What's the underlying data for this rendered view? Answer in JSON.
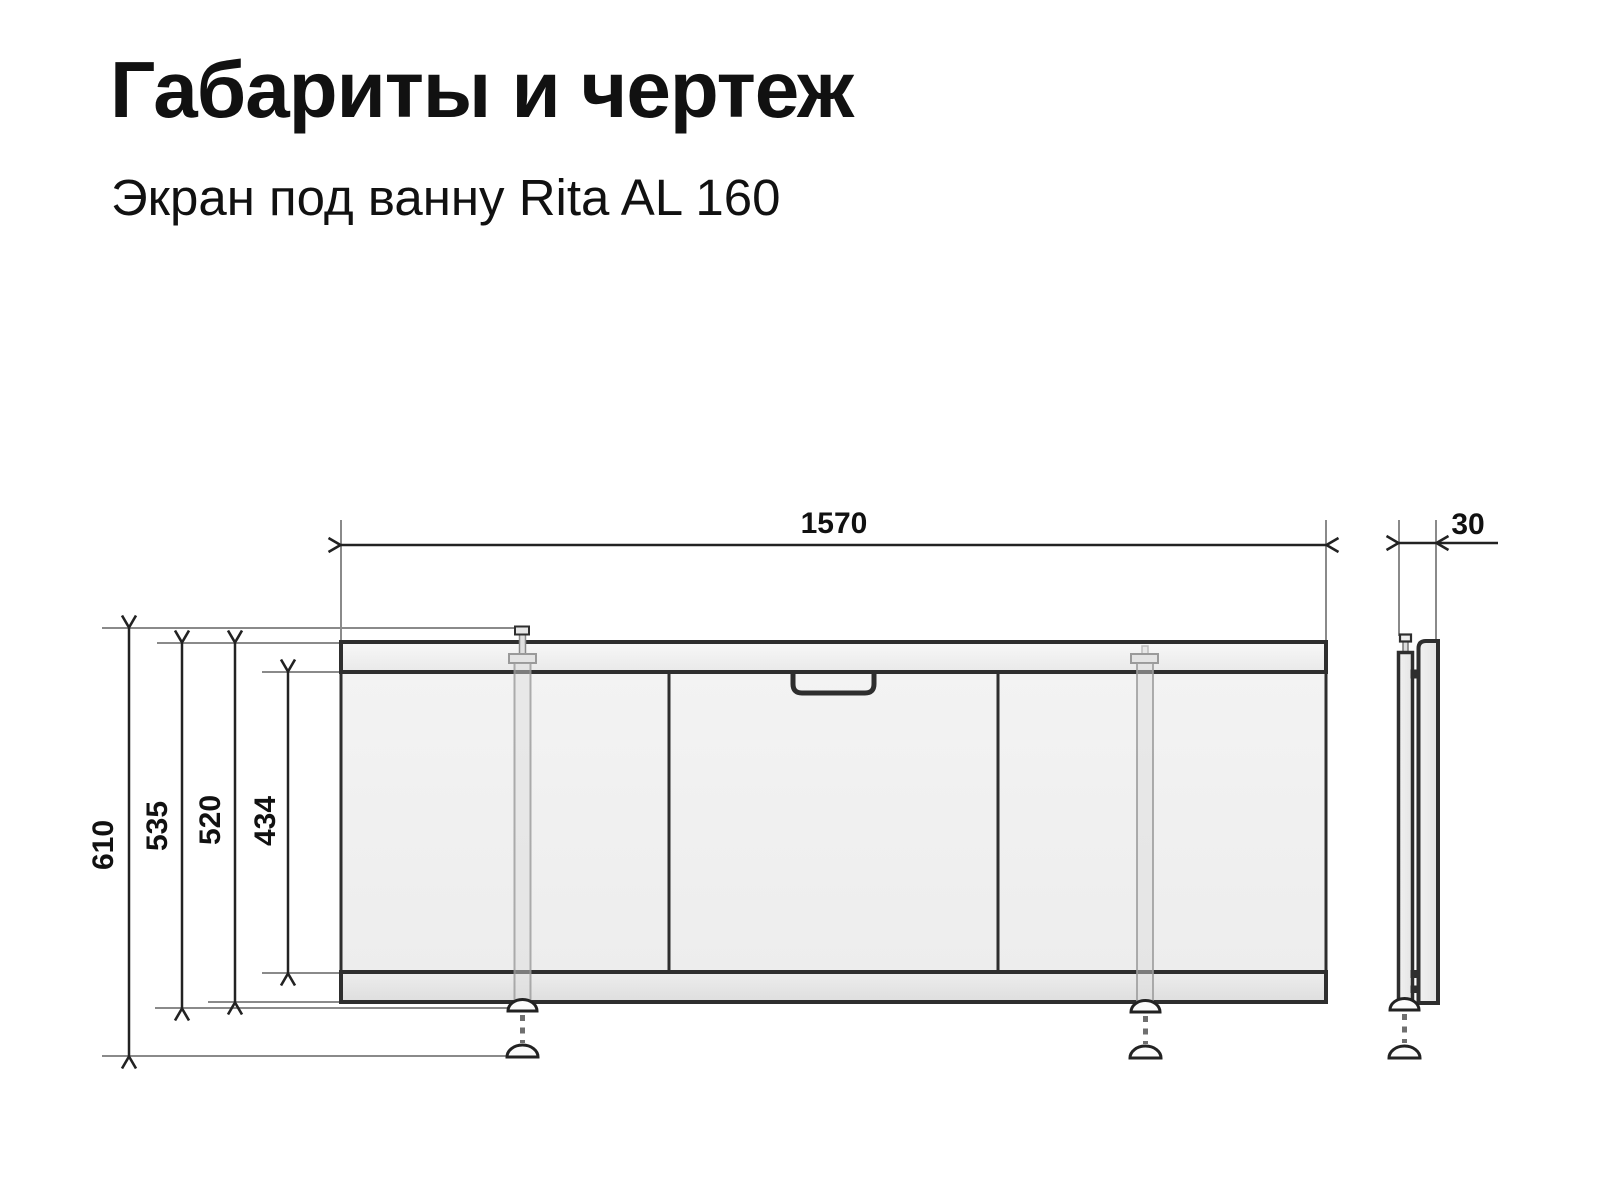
{
  "header": {
    "title": "Габариты и чертеж",
    "subtitle": "Экран под ванну Rita AL 160"
  },
  "dimensions": {
    "width": "1570",
    "depth": "30",
    "overall_height": "610",
    "height_feet_retracted": "535",
    "panel_height": "520",
    "inner_panel_height": "434"
  },
  "colors": {
    "background": "#ffffff",
    "text": "#111111",
    "dimension_lines": "#222222",
    "extension_lines": "#8a8a8a",
    "outline": "#2e2e2e",
    "panel_fill": "#f0f0f0"
  }
}
